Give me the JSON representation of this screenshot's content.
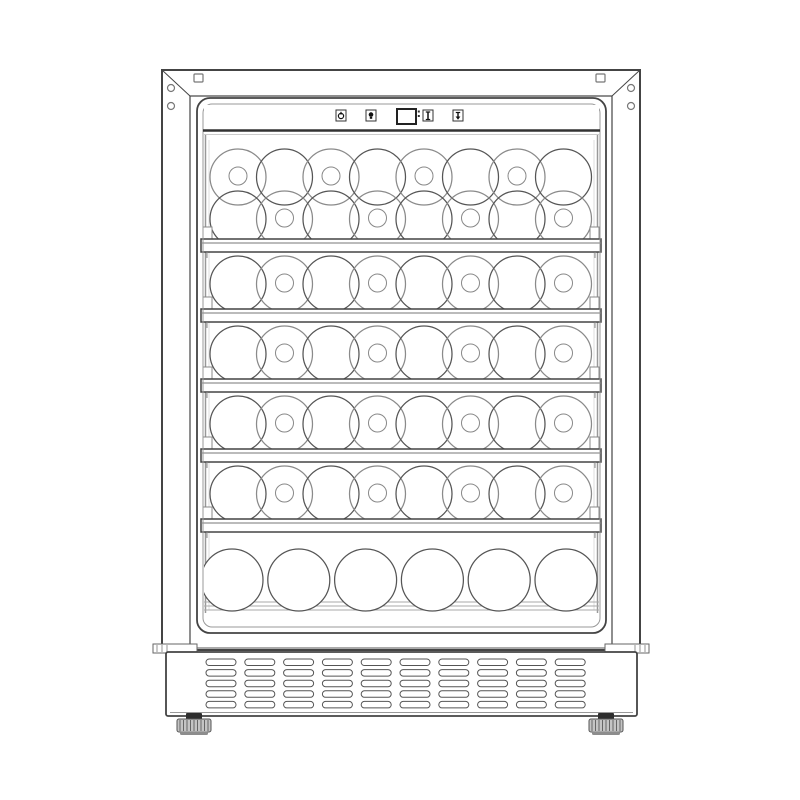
{
  "illustration": {
    "subject": "built-in wine cooler front-view line drawing",
    "colors": {
      "background": "#ffffff",
      "line": "#444444",
      "line_medium": "#777777",
      "line_light": "#aaaaaa",
      "wall_line": "#999999",
      "bottle_line": "#555555",
      "bottle_line_light": "#8a8a8a",
      "glyph": "#111111",
      "foot_fill": "#c4c4c4",
      "foot_cap": "#2e2e2e",
      "foot_base": "#8d8d8d"
    },
    "frame": {
      "screw_holes": 4,
      "mounting_slots": 2
    },
    "control_panel": {
      "buttons": [
        {
          "name": "power-button",
          "icon": "power-icon"
        },
        {
          "name": "light-button",
          "icon": "light-icon"
        },
        {
          "name": "up-button",
          "icon": "up-arrow-icon"
        },
        {
          "name": "down-button",
          "icon": "down-arrow-icon"
        }
      ],
      "display": {
        "value": "",
        "degree_marks": 2
      }
    },
    "shelves": {
      "count": 5
    },
    "bottle_sections": [
      {
        "name": "top-section",
        "rows": [
          {
            "count": 8,
            "neck_positions": [
              0,
              2,
              4,
              6
            ]
          },
          {
            "count": 8,
            "neck_positions": [
              1,
              3,
              5,
              7
            ]
          }
        ]
      },
      {
        "name": "section-2",
        "rows": [
          {
            "count": 8,
            "neck_positions": [
              1,
              3,
              5,
              7
            ]
          }
        ]
      },
      {
        "name": "section-3",
        "rows": [
          {
            "count": 8,
            "neck_positions": [
              1,
              3,
              5,
              7
            ]
          }
        ]
      },
      {
        "name": "section-4",
        "rows": [
          {
            "count": 8,
            "neck_positions": [
              1,
              3,
              5,
              7
            ]
          }
        ]
      },
      {
        "name": "section-5",
        "rows": [
          {
            "count": 8,
            "neck_positions": [
              1,
              3,
              5,
              7
            ]
          }
        ]
      },
      {
        "name": "bottom-section",
        "rows": [
          {
            "count": 6,
            "neck_positions": []
          }
        ]
      }
    ],
    "vent_grille": {
      "columns": 10,
      "rows": 5
    },
    "feet": {
      "count": 2
    }
  }
}
